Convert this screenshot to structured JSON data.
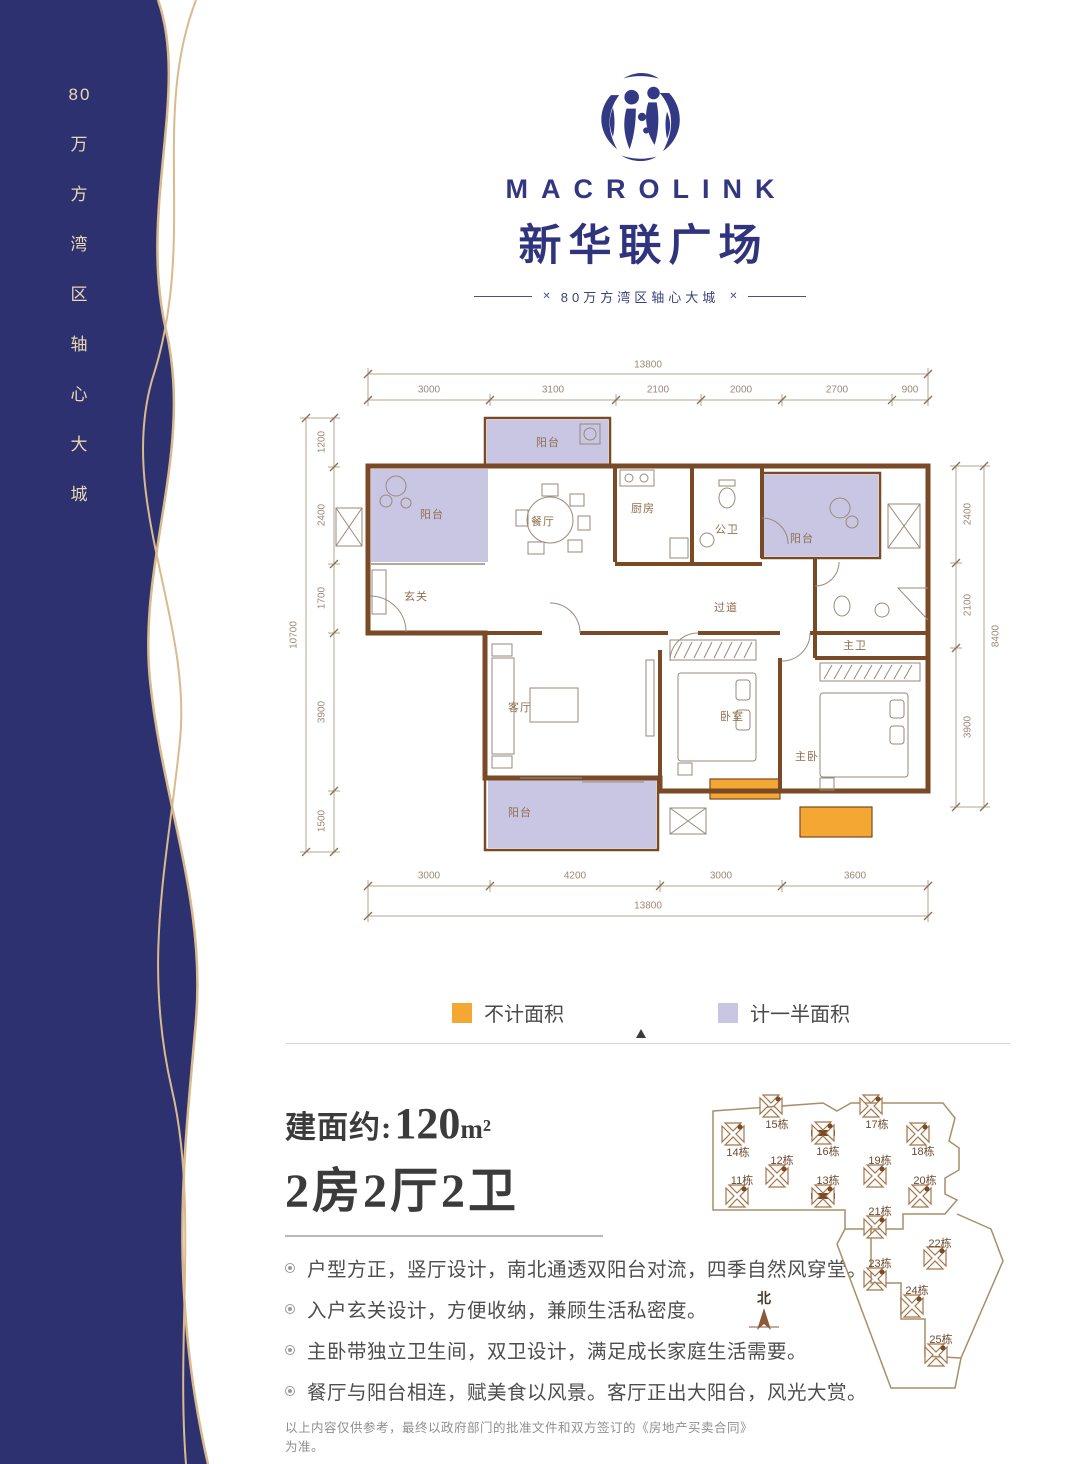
{
  "sidebar": {
    "vertical_tokens": [
      "80",
      "万",
      "方",
      "湾",
      "区",
      "轴",
      "心",
      "大",
      "城"
    ]
  },
  "logo": {
    "brand": "MACROLINK",
    "name": "新华联广场",
    "tagline": "80万方湾区轴心大城"
  },
  "floorplan": {
    "rooms": {
      "balcony_top": "阳台",
      "balcony_left": "阳台",
      "dining": "餐厅",
      "kitchen": "厨房",
      "guest_bath": "公卫",
      "balcony_right": "阳台",
      "foyer": "玄关",
      "corridor": "过道",
      "living": "客厅",
      "bedroom": "卧室",
      "master_bedroom": "主卧",
      "master_bath": "主卫",
      "balcony_bottom": "阳台"
    },
    "dims": {
      "top_overall": "13800",
      "top_segments": [
        "3000",
        "3100",
        "2100",
        "2000",
        "2700",
        "900"
      ],
      "left_overall": "10700",
      "left_segments": [
        "1200",
        "2400",
        "1700",
        "3900",
        "1500"
      ],
      "right_overall": "8400",
      "right_segments": [
        "2400",
        "2100",
        "3900"
      ],
      "bottom_overall": "13800",
      "bottom_segments": [
        "3000",
        "4200",
        "3000",
        "3600"
      ]
    }
  },
  "legend": {
    "no_area": "不计面积",
    "half_area": "计一半面积"
  },
  "unit": {
    "area_label": "建面约",
    "area_colon": ":",
    "area_value": "120",
    "area_unit": "m²",
    "headline": "2房2厅2卫",
    "features": [
      "户型方正，竖厅设计，南北通透双阳台对流，四季自然风穿堂。",
      "入户玄关设计，方便收纳，兼顾生活私密度。",
      "主卧带独立卫生间，双卫设计，满足成长家庭生活需要。",
      "餐厅与阳台相连，赋美食以风景。客厅正出大阳台，风光大赏。"
    ],
    "disclaimer": "以上内容仅供参考，最终以政府部门的批准文件和双方签订的《房地产买卖合同》为准。"
  },
  "siteplan": {
    "buildings": [
      "11栋",
      "12栋",
      "13栋",
      "14栋",
      "15栋",
      "16栋",
      "17栋",
      "18栋",
      "19栋",
      "20栋",
      "21栋",
      "22栋",
      "23栋",
      "24栋",
      "25栋"
    ],
    "north": "北"
  },
  "colors": {
    "sidebar_navy": "#2d3170",
    "gold": "#d9ba8c",
    "brand_navy": "#32377f",
    "wall_brown": "#7a4a26",
    "half_area_fill": "#c8c6e2",
    "no_area_fill": "#f5a733"
  }
}
